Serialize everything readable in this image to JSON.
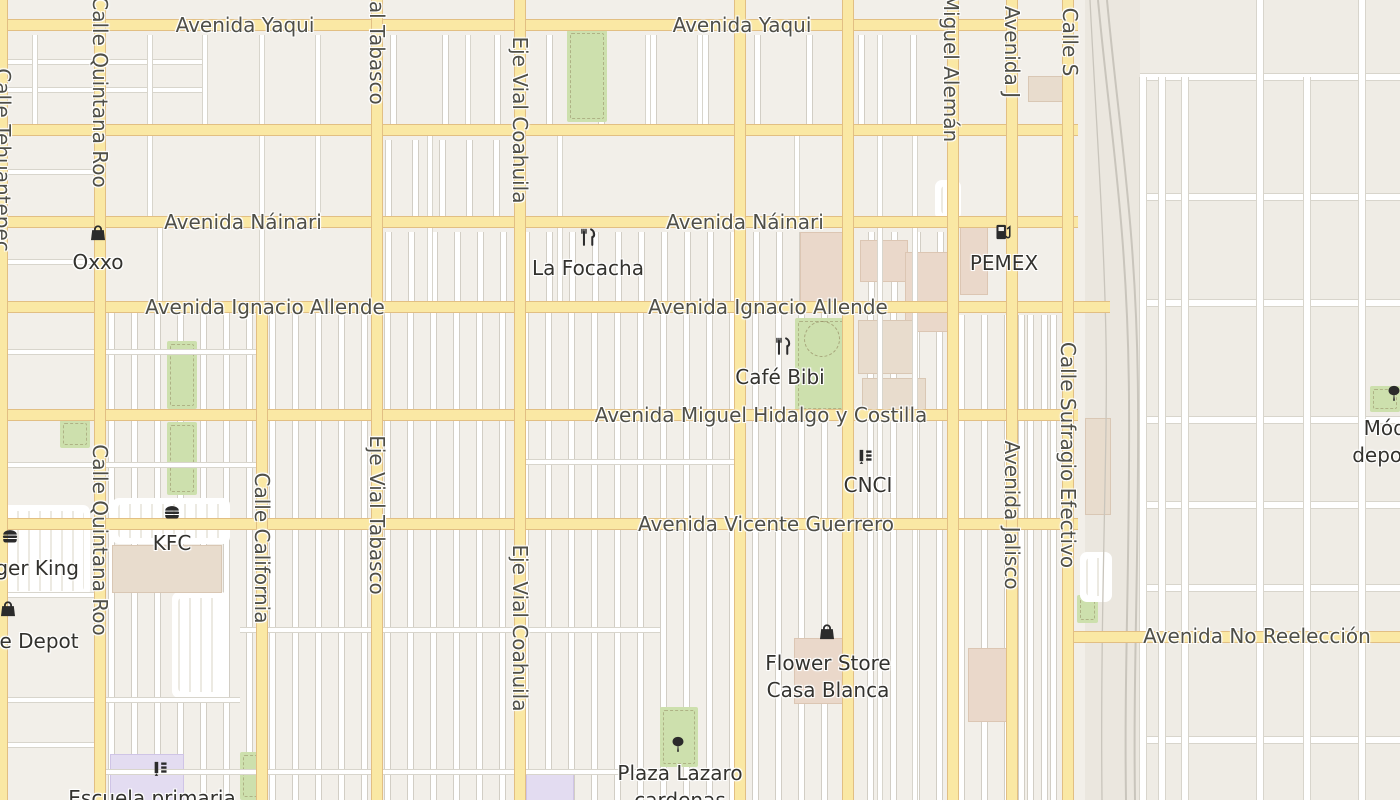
{
  "map": {
    "colors": {
      "background": "#f2efe9",
      "background_right_zone": "#efece5",
      "background_rail_strip": "#ebe7df",
      "road_major_fill": "#fae8a4",
      "road_major_casing": "#e2bf83",
      "road_minor_fill": "#ffffff",
      "road_minor_casing": "#d8d5cc",
      "park_green": "#cde0ad",
      "building_tan": "#e8dccd",
      "building_pink": "#ead8ca",
      "building_school": "#e3dcf1",
      "railway_gray": "#c9c5bc",
      "street_label_color": "#4f4f48",
      "poi_label_color": "#33322e",
      "poi_icon_color": "#2b2b2b"
    },
    "streets": {
      "horizontal": [
        {
          "name": "Avenida Yaqui",
          "y": 25,
          "x1": 0,
          "x2": 1078
        },
        {
          "name": "",
          "y": 130,
          "x1": 0,
          "x2": 1078
        },
        {
          "name": "Avenida Náinari",
          "y": 222,
          "x1": 0,
          "x2": 1078
        },
        {
          "name": "Avenida Ignacio Allende",
          "y": 307,
          "x1": 0,
          "x2": 1110
        },
        {
          "name": "Avenida Miguel Hidalgo y Costilla",
          "y": 415,
          "x1": 0,
          "x2": 1078
        },
        {
          "name": "Avenida Vicente Guerrero",
          "y": 524,
          "x1": 0,
          "x2": 1078
        },
        {
          "name": "Avenida No Reelección",
          "y": 637,
          "x1": 1064,
          "x2": 1400
        }
      ],
      "vertical": [
        {
          "name": "Calle Tehuantepec",
          "x": 2,
          "y1": 0,
          "y2": 800
        },
        {
          "name": "Calle Quintana Roo",
          "x": 100,
          "y1": 0,
          "y2": 800
        },
        {
          "name": "Calle California",
          "x": 262,
          "y1": 302,
          "y2": 800
        },
        {
          "name": "Eje Vial Tabasco",
          "x": 377,
          "y1": 0,
          "y2": 800
        },
        {
          "name": "Eje Vial Coahuila",
          "x": 520,
          "y1": 0,
          "y2": 800
        },
        {
          "name": "",
          "x": 740,
          "y1": 0,
          "y2": 800
        },
        {
          "name": "",
          "x": 848,
          "y1": 0,
          "y2": 800
        },
        {
          "name": "Miguel Alemán",
          "x": 953,
          "y1": 0,
          "y2": 800
        },
        {
          "name": "Avenida Jalisco",
          "x": 1012,
          "y1": 0,
          "y2": 800
        },
        {
          "name": "Calle Sufragio Efectivo",
          "x": 1068,
          "y1": 0,
          "y2": 800
        }
      ]
    },
    "street_labels": [
      {
        "text": "Avenida Yaqui",
        "x": 245,
        "y": 25,
        "vertical": false
      },
      {
        "text": "Avenida Yaqui",
        "x": 742,
        "y": 25,
        "vertical": false
      },
      {
        "text": "Avenida Náinari",
        "x": 243,
        "y": 222,
        "vertical": false
      },
      {
        "text": "Avenida Náinari",
        "x": 745,
        "y": 222,
        "vertical": false
      },
      {
        "text": "Avenida Ignacio Allende",
        "x": 265,
        "y": 307,
        "vertical": false
      },
      {
        "text": "Avenida Ignacio Allende",
        "x": 768,
        "y": 307,
        "vertical": false
      },
      {
        "text": "Avenida Miguel Hidalgo y Costilla",
        "x": 761,
        "y": 415,
        "vertical": false
      },
      {
        "text": "Avenida Vicente Guerrero",
        "x": 766,
        "y": 524,
        "vertical": false
      },
      {
        "text": "Avenida No Reelección",
        "x": 1257,
        "y": 636,
        "vertical": false
      },
      {
        "text": "Calle Tehuantepec",
        "x": 3,
        "y": 160,
        "vertical": true
      },
      {
        "text": "Calle Quintana Roo",
        "x": 100,
        "y": 92,
        "vertical": true
      },
      {
        "text": "Calle Quintana Roo",
        "x": 100,
        "y": 540,
        "vertical": true
      },
      {
        "text": "Calle California",
        "x": 262,
        "y": 548,
        "vertical": true
      },
      {
        "text": "Eje Vial Tabasco",
        "x": 377,
        "y": 25,
        "vertical": true
      },
      {
        "text": "Eje Vial Tabasco",
        "x": 377,
        "y": 515,
        "vertical": true
      },
      {
        "text": "Eje Vial Coahuila",
        "x": 520,
        "y": 120,
        "vertical": true
      },
      {
        "text": "Eje Vial Coahuila",
        "x": 520,
        "y": 628,
        "vertical": true
      },
      {
        "text": "Miguel Alemán",
        "x": 951,
        "y": 68,
        "vertical": true
      },
      {
        "text": "Avenida J",
        "x": 1012,
        "y": 52,
        "vertical": true
      },
      {
        "text": "Avenida Jalisco",
        "x": 1012,
        "y": 515,
        "vertical": true
      },
      {
        "text": "Calle S",
        "x": 1070,
        "y": 42,
        "vertical": true
      },
      {
        "text": "Calle Sufragio Efectivo",
        "x": 1068,
        "y": 455,
        "vertical": true
      }
    ],
    "pois": [
      {
        "id": "oxxo",
        "icon": "shopping-bag",
        "icon_x": 98,
        "icon_y": 233,
        "label_x": 98,
        "label_y": 262,
        "lines": [
          "Oxxo"
        ]
      },
      {
        "id": "la-focacha",
        "icon": "restaurant",
        "icon_x": 588,
        "icon_y": 237,
        "label_x": 588,
        "label_y": 268,
        "lines": [
          "La Focacha"
        ]
      },
      {
        "id": "pemex",
        "icon": "fuel",
        "icon_x": 1003,
        "icon_y": 232,
        "label_x": 1004,
        "label_y": 263,
        "lines": [
          "PEMEX"
        ]
      },
      {
        "id": "cafe-bibi",
        "icon": "restaurant",
        "icon_x": 783,
        "icon_y": 346,
        "label_x": 780,
        "label_y": 377,
        "lines": [
          "Café Bibi"
        ]
      },
      {
        "id": "cnci",
        "icon": "school",
        "icon_x": 865,
        "icon_y": 457,
        "label_x": 868,
        "label_y": 485,
        "lines": [
          "CNCI"
        ]
      },
      {
        "id": "kfc",
        "icon": "burger",
        "icon_x": 172,
        "icon_y": 512,
        "label_x": 172,
        "label_y": 543,
        "lines": [
          "KFC"
        ]
      },
      {
        "id": "burger-king",
        "icon": "burger",
        "icon_x": 10,
        "icon_y": 536,
        "label_x": 20,
        "label_y": 568,
        "lines": [
          "Burger King"
        ]
      },
      {
        "id": "office-depot",
        "icon": "shopping-bag",
        "icon_x": 8,
        "icon_y": 609,
        "label_x": 16,
        "label_y": 641,
        "lines": [
          "Office Depot"
        ]
      },
      {
        "id": "flower-store-casa-blanca",
        "icon": "shopping-bag",
        "icon_x": 827,
        "icon_y": 632,
        "label_x": 828,
        "label_y": 663,
        "lines": [
          "Flower Store",
          "Casa Blanca"
        ]
      },
      {
        "id": "plaza-lazaro-cardenas",
        "icon": "tree",
        "icon_x": 678,
        "icon_y": 744,
        "label_x": 680,
        "label_y": 773,
        "lines": [
          "Plaza Lazaro",
          "cardenas"
        ]
      },
      {
        "id": "escuela-primaria",
        "icon": "school",
        "icon_x": 160,
        "icon_y": 769,
        "label_x": 152,
        "label_y": 798,
        "lines": [
          "Escuela primaria"
        ]
      },
      {
        "id": "modulo-deportivo",
        "icon": "tree",
        "icon_x": 1394,
        "icon_y": 393,
        "label_x": 1400,
        "label_y": 428,
        "lines": [
          "Módulo",
          "deportivo"
        ]
      }
    ],
    "geometry": {
      "rail_strip": [
        1085,
        0,
        55,
        800
      ],
      "right_zone": [
        1140,
        0,
        260,
        800
      ],
      "parks": [
        [
          567,
          30,
          40,
          92
        ],
        [
          167,
          341,
          30,
          68
        ],
        [
          167,
          422,
          30,
          73
        ],
        [
          60,
          420,
          30,
          28
        ],
        [
          795,
          318,
          58,
          94
        ],
        [
          660,
          707,
          38,
          60
        ],
        [
          240,
          752,
          22,
          48
        ],
        [
          1077,
          595,
          21,
          28
        ],
        [
          1370,
          386,
          30,
          26
        ]
      ],
      "park_circle": [
        804,
        321,
        34
      ],
      "buildings": [
        [
          112,
          545,
          108,
          46,
          "tan"
        ],
        [
          800,
          232,
          52,
          68,
          "pink"
        ],
        [
          860,
          240,
          46,
          40,
          "pink"
        ],
        [
          905,
          252,
          48,
          78,
          "pink"
        ],
        [
          858,
          320,
          58,
          52,
          "tan"
        ],
        [
          862,
          378,
          62,
          38,
          "tan"
        ],
        [
          794,
          638,
          48,
          64,
          "pink"
        ],
        [
          968,
          648,
          42,
          72,
          "pink"
        ],
        [
          1028,
          76,
          34,
          24,
          "tan"
        ],
        [
          1085,
          418,
          24,
          95,
          "tan"
        ],
        [
          960,
          225,
          26,
          68,
          "pink"
        ],
        [
          110,
          754,
          72,
          46,
          "school"
        ],
        [
          526,
          774,
          46,
          26,
          "school"
        ]
      ],
      "parking": [
        [
          0,
          505,
          90,
          92
        ],
        [
          112,
          498,
          118,
          46
        ],
        [
          172,
          592,
          56,
          106
        ],
        [
          1080,
          552,
          32,
          50
        ],
        [
          935,
          180,
          26,
          40
        ]
      ],
      "lots": [
        [
          108,
          313,
          840,
          487,
          23
        ],
        [
          385,
          232,
          563,
          73,
          23
        ],
        [
          385,
          140,
          133,
          76,
          27
        ],
        [
          390,
          35,
          553,
          90,
          52
        ],
        [
          958,
          315,
          104,
          485,
          23
        ],
        [
          1018,
          315,
          45,
          485,
          23
        ]
      ],
      "minor_h": [
        [
          62,
          0,
          205
        ],
        [
          90,
          0,
          205
        ],
        [
          172,
          0,
          100
        ],
        [
          262,
          0,
          100
        ],
        [
          352,
          0,
          260
        ],
        [
          465,
          0,
          260
        ],
        [
          462,
          520,
          740
        ],
        [
          595,
          0,
          95
        ],
        [
          630,
          240,
          660
        ],
        [
          700,
          0,
          240
        ],
        [
          745,
          0,
          95
        ],
        [
          772,
          95,
          660
        ]
      ],
      "minor_v": [
        [
          35,
          35,
          130
        ],
        [
          150,
          35,
          218
        ],
        [
          205,
          35,
          130
        ],
        [
          262,
          35,
          302
        ],
        [
          318,
          35,
          218
        ],
        [
          160,
          222,
          307
        ],
        [
          430,
          130,
          307
        ],
        [
          468,
          35,
          130
        ],
        [
          560,
          130,
          307
        ],
        [
          648,
          35,
          130
        ],
        [
          700,
          35,
          130
        ],
        [
          797,
          130,
          222
        ],
        [
          880,
          35,
          800
        ],
        [
          915,
          130,
          800
        ]
      ],
      "right_h": [
        [
          77,
          1140,
          1400
        ],
        [
          197,
          1140,
          1400
        ],
        [
          303,
          1140,
          1400
        ],
        [
          420,
          1140,
          1400
        ],
        [
          505,
          1140,
          1400
        ],
        [
          588,
          1140,
          1400
        ],
        [
          740,
          1140,
          1400
        ]
      ],
      "right_v": [
        [
          1143,
          77,
          800
        ],
        [
          1162,
          77,
          800
        ],
        [
          1185,
          77,
          800
        ],
        [
          1260,
          0,
          800
        ],
        [
          1307,
          77,
          800
        ],
        [
          1362,
          0,
          800
        ]
      ],
      "railway_paths": [
        "M1098 0 C1110 130 1128 230 1129 400 C1130 560 1124 670 1126 800",
        "M1107 0 C1119 130 1137 230 1138 400 C1139 560 1133 670 1135 800",
        "M1090 0 C1096 120 1104 230 1106 340 C1108 450 1100 600 1102 800"
      ]
    }
  }
}
